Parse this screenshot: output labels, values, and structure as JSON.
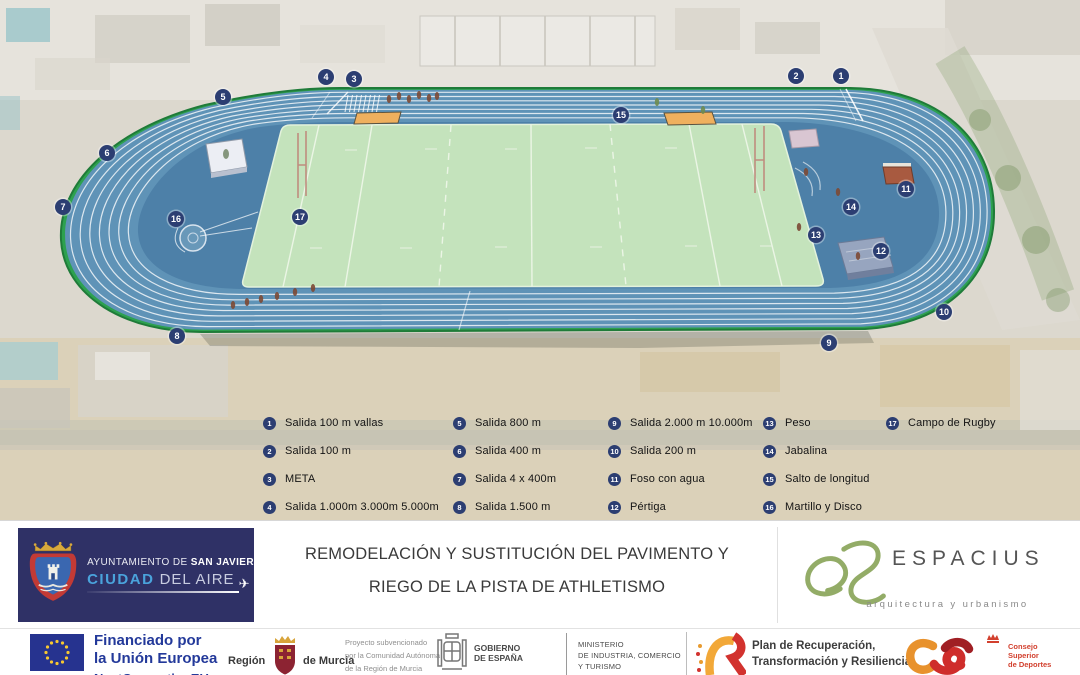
{
  "map": {
    "markers": [
      "1",
      "2",
      "3",
      "4",
      "5",
      "6",
      "7",
      "8",
      "9",
      "10",
      "11",
      "12",
      "13",
      "14",
      "15",
      "16",
      "17"
    ]
  },
  "legend": {
    "items": [
      {
        "num": "1",
        "label": "Salida 100 m vallas"
      },
      {
        "num": "2",
        "label": "Salida 100 m"
      },
      {
        "num": "3",
        "label": "META"
      },
      {
        "num": "4",
        "label": "Salida 1.000m 3.000m 5.000m"
      },
      {
        "num": "5",
        "label": "Salida 800 m"
      },
      {
        "num": "6",
        "label": "Salida 400 m"
      },
      {
        "num": "7",
        "label": "Salida 4 x 400m"
      },
      {
        "num": "8",
        "label": "Salida 1.500 m"
      },
      {
        "num": "9",
        "label": "Salida 2.000 m 10.000m"
      },
      {
        "num": "10",
        "label": "Salida 200 m"
      },
      {
        "num": "11",
        "label": "Foso con agua"
      },
      {
        "num": "12",
        "label": "Pértiga"
      },
      {
        "num": "13",
        "label": "Peso"
      },
      {
        "num": "14",
        "label": "Jabalina"
      },
      {
        "num": "15",
        "label": "Salto de longitud"
      },
      {
        "num": "16",
        "label": "Martillo y Disco"
      },
      {
        "num": "17",
        "label": "Campo de Rugby"
      }
    ]
  },
  "footer": {
    "municipality": {
      "line1_prefix": "AYUNTAMIENTO DE",
      "line1_bold": "SAN JAVIER",
      "line2_highlight": "CIUDAD",
      "line2_rest": "DEL AIRE"
    },
    "title_line1": "REMODELACIÓN Y SUSTITUCIÓN DEL PAVIMENTO Y",
    "title_line2": "RIEGO DE LA PISTA DE ATHLETISMO",
    "studio": {
      "name": "ESPACIUS",
      "tagline": "arquitectura y urbanismo"
    }
  },
  "sponsors": {
    "eu": {
      "line1": "Financiado por",
      "line2": "la Unión Europea",
      "line3": "NextGenerationEU"
    },
    "murcia": {
      "left": "Región",
      "right": "de Murcia"
    },
    "subsidy": [
      "Proyecto subvencionado",
      "por la Comunidad Autónoma",
      "de la Región de Murcia"
    ],
    "gobierno": [
      "GOBIERNO",
      "DE ESPAÑA"
    ],
    "ministerio": [
      "MINISTERIO",
      "DE INDUSTRIA, COMERCIO",
      "Y TURISMO"
    ],
    "prtr": [
      "Plan de Recuperación,",
      "Transformación y Resiliencia"
    ],
    "csd": [
      "Consejo",
      "Superior",
      "de Deportes"
    ]
  },
  "icons": {
    "airplane": "✈"
  },
  "colors": {
    "track_blue": "#5f93b7",
    "dzone_blue": "#4d80a8",
    "infield_green": "#c4e3bc",
    "border_green": "#2da14f",
    "marker_navy": "#2c3e72",
    "sand_pit": "#efb05e",
    "eu_blue": "#23399a",
    "prtr_red": "#d2322e",
    "prtr_yellow": "#f2a838",
    "espacius_green": "#93ac67"
  }
}
